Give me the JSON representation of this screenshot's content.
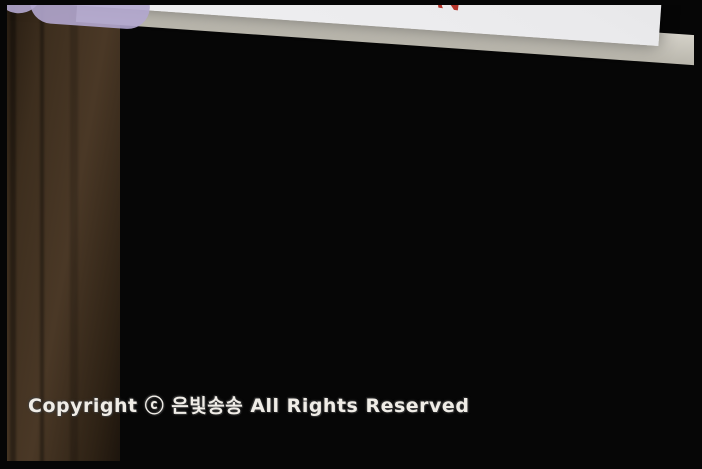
{
  "photo": {
    "watermark": "Copyright ⓒ 은빛송송 All Rights Reserved"
  },
  "header": {
    "step_label": "Step",
    "step_number": "3",
    "title_prefix": "실력을 키우는",
    "title_letters": [
      "유",
      "형",
      "탐",
      "험"
    ]
  },
  "left_column": {
    "banner": "전개도에서 밑면 알아보기",
    "p1": {
      "level": "기본",
      "number": "1",
      "line1": "전개도를 접었을 때 밑면이 되는 면을 모두",
      "line2": "찾아 색칠하시오."
    },
    "p2": {
      "level": "실력",
      "number": "2",
      "line1": "㉠이 사각기둥의 한 밑면일 때, 다른 한 밑면",
      "line2": "을 찾아 기호를 쓰시오.",
      "answer": "(            )",
      "net_labels": {
        "top": "㉡",
        "row": [
          "㉠",
          "㉢",
          "㉤",
          "㉥"
        ],
        "bottom": "㉣"
      }
    }
  },
  "right_column": {
    "banner": "전개도를 접었을 때 맞닿는 면",
    "p4": {
      "level": "기본",
      "number": "4",
      "line1": "전개도를 접었을 때 변 ㄷㄹ과 맞닿는",
      "line2": "찾아 써 보시오.",
      "answer": "(            )",
      "vertex_labels": [
        "ㄱ",
        "ㄴ",
        "ㄷ",
        "ㄹ",
        "ㅁ",
        "ㅂ",
        "ㅅ",
        "ㅇ"
      ]
    },
    "p5": {
      "level": "실력",
      "number": "5",
      "line1": "전개도를 접었을 때 ㉮와 마주 보는",
      "line2": "엇입니까?",
      "answer": "(            )",
      "net_labels": {
        "top": "㉲",
        "row": [
          "㉮",
          "㉯",
          "㉰",
          "㉱"
        ],
        "bottom": "㉳"
      }
    }
  },
  "colors": {
    "page_bg": "#e9e9eb",
    "banner_green": "#cfe3ad",
    "ribbon_salmon": "#dda9a4",
    "net_purple": "#b696c6",
    "net_purple_light": "#cdb2d8",
    "net_yellow": "#eadc8e",
    "number_red": "#b5342a",
    "step_blue": "#3e85c8"
  }
}
